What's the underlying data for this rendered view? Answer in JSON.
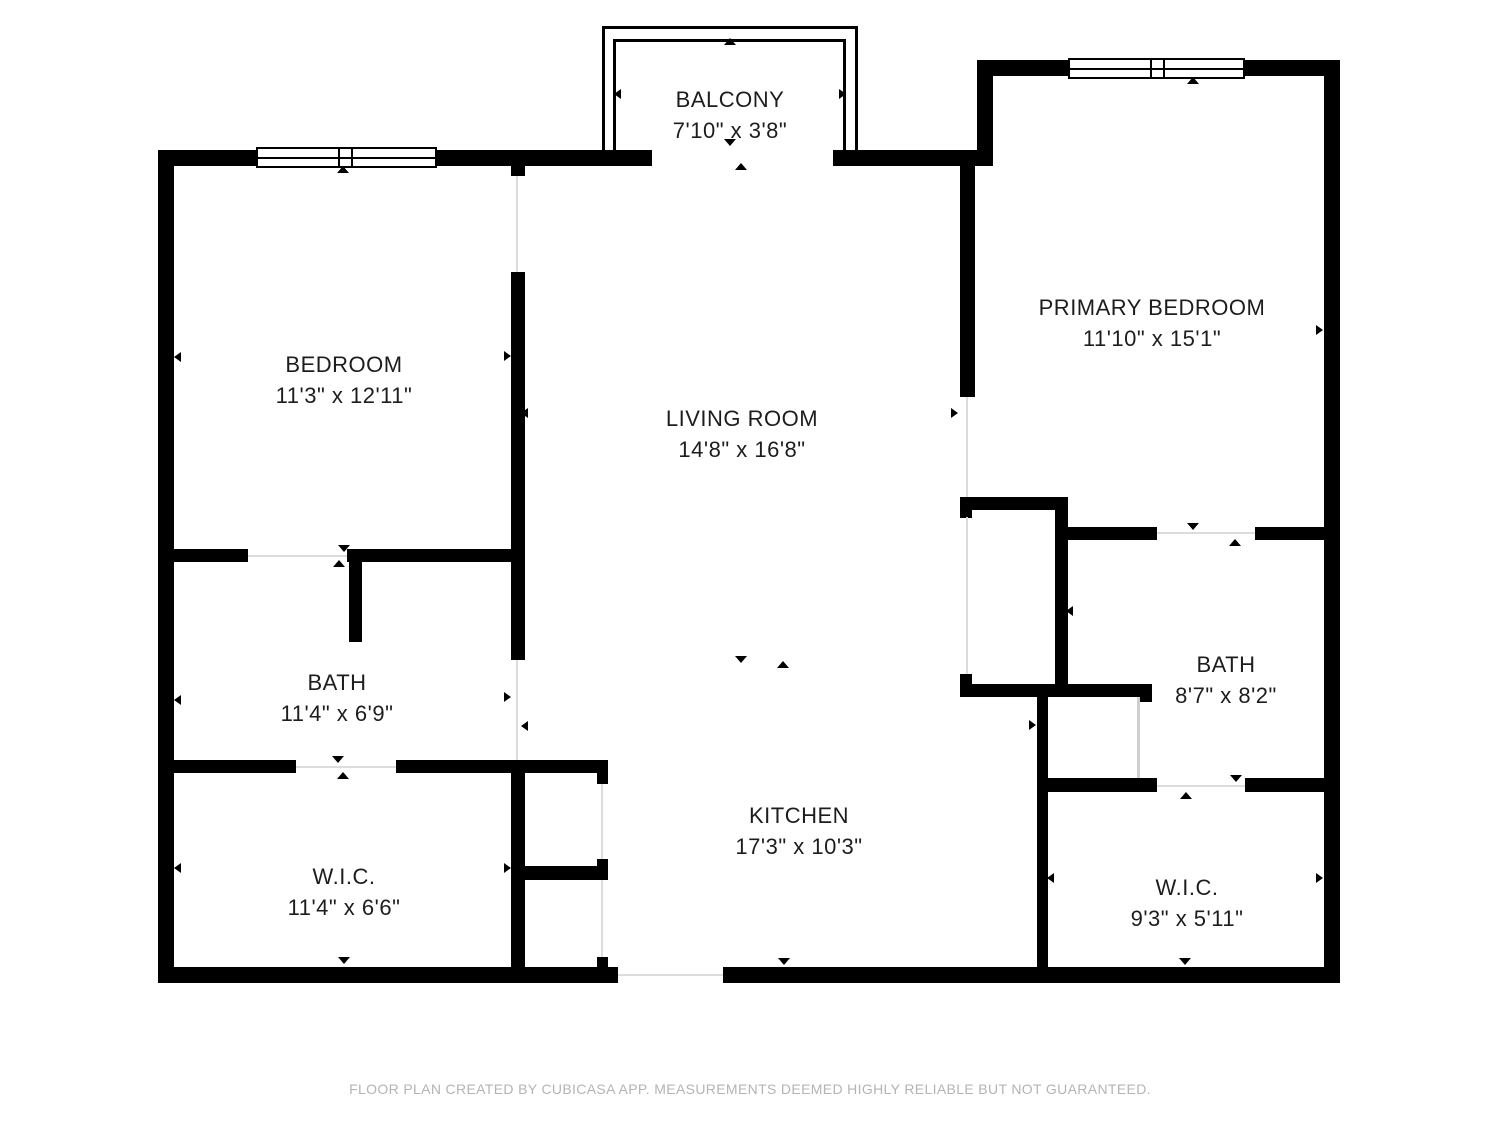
{
  "page": {
    "footer": "FLOOR PLAN CREATED BY CUBICASA APP. MEASUREMENTS DEEMED HIGHLY RELIABLE BUT NOT GUARANTEED."
  },
  "colors": {
    "wall": "#000000",
    "room_text": "#1d1d1d",
    "footer_text": "#b4b4b4",
    "door_line": "#dcdcdc",
    "background": "#ffffff"
  },
  "rooms": [
    {
      "id": "balcony",
      "name": "BALCONY",
      "dims": "7'10\" x 3'8\""
    },
    {
      "id": "bedroom",
      "name": "BEDROOM",
      "dims": "11'3\" x 12'11\""
    },
    {
      "id": "living-room",
      "name": "LIVING ROOM",
      "dims": "14'8\" x 16'8\""
    },
    {
      "id": "primary-bedroom",
      "name": "PRIMARY BEDROOM",
      "dims": "11'10\" x 15'1\""
    },
    {
      "id": "bath-left",
      "name": "BATH",
      "dims": "11'4\" x 6'9\""
    },
    {
      "id": "bath-right",
      "name": "BATH",
      "dims": "8'7\" x 8'2\""
    },
    {
      "id": "wic-left",
      "name": "W.I.C.",
      "dims": "11'4\" x 6'6\""
    },
    {
      "id": "wic-right",
      "name": "W.I.C.",
      "dims": "9'3\" x 5'11\""
    },
    {
      "id": "kitchen",
      "name": "KITCHEN",
      "dims": "17'3\" x 10'3\""
    }
  ]
}
